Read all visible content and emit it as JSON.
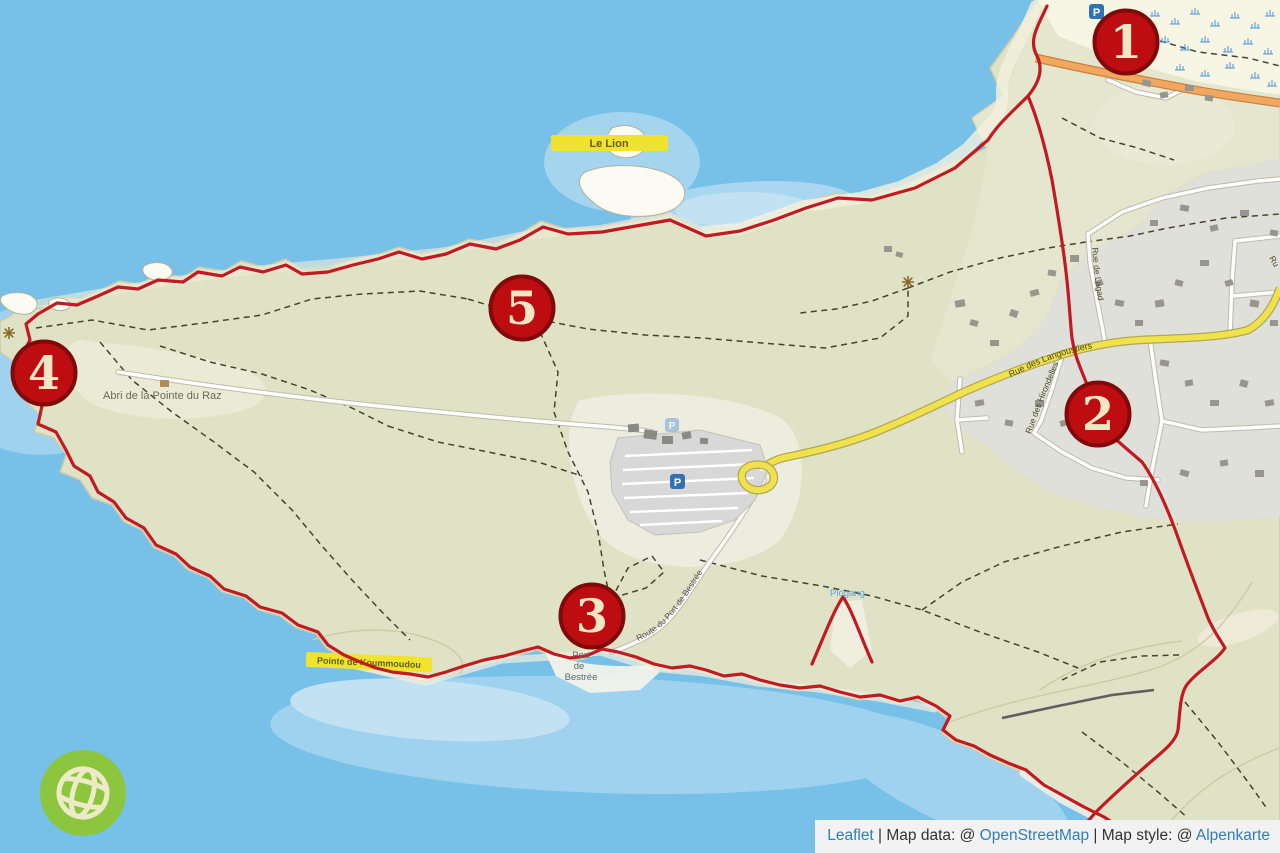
{
  "attribution": {
    "leaflet_link": "Leaflet",
    "map_data_prefix": " | Map data: @ ",
    "osm_link": "OpenStreetMap",
    "map_style_prefix": " | Map style: @ ",
    "style_link": "Alpenkarte"
  },
  "markers": [
    {
      "label": "1"
    },
    {
      "label": "2"
    },
    {
      "label": "3"
    },
    {
      "label": "4"
    },
    {
      "label": "5"
    }
  ],
  "labels": {
    "le_lion": "Le Lion",
    "pointe_headland": "Pointe de Koummoudou",
    "abri": "Abri de la Pointe du Raz",
    "port_bestree_line1": "Port",
    "port_bestree_line2": "de",
    "port_bestree_line3": "Bestrée",
    "route_bestree": "Route du Port de Bestrée",
    "rue_langoustiers": "Rue des Langoustiers",
    "rue_hirondelles": "Rue des Hirondelles",
    "rue_lagad": "Rue de Lagad",
    "rue_clipped": "Ru",
    "cove_blue": "Plogang",
    "parking_glyph": "P"
  },
  "icons": {
    "parking": "parking-icon",
    "viewpoint": "viewpoint-icon",
    "marsh": "marsh-icon",
    "globe_logo": "globe-logo-icon"
  },
  "colors": {
    "sea": "#77C0E8",
    "shallow_water": "#A3D4F0",
    "land": "#DFE2C4",
    "residential": "#E0E0DA",
    "beach": "#F7F5E3",
    "road_yellow": "#EFE24A",
    "road_orange": "#F0A860",
    "trail_red": "#C11A22",
    "marker_fill": "#BE0D10",
    "marker_border": "#7F0A0A",
    "marker_text": "#F2E7C5",
    "label_yellow": "#EFE32E",
    "logo_green": "#8CC63E",
    "link_blue": "#2E7EB8"
  }
}
